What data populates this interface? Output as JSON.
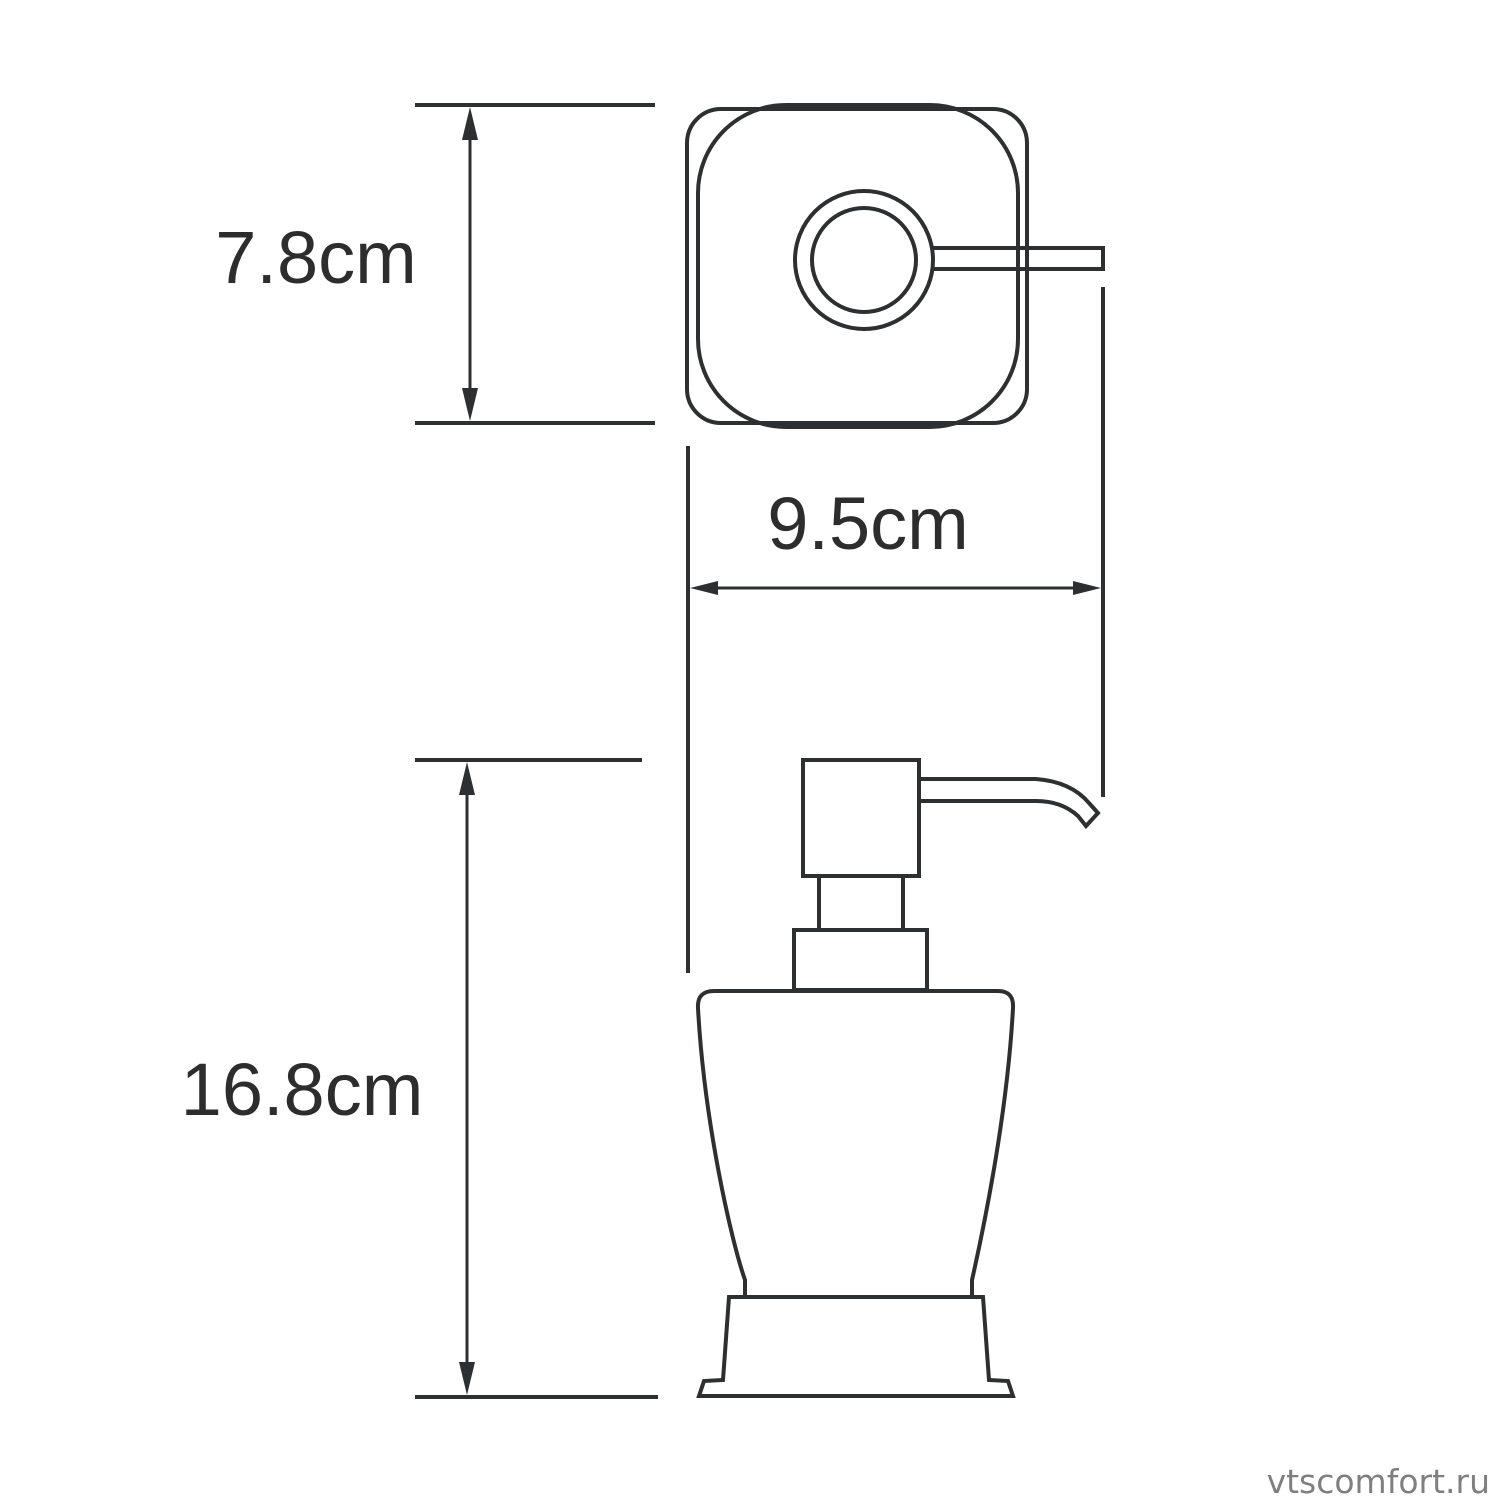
{
  "diagram": {
    "dimensions": [
      {
        "id": "top-view-depth",
        "label": "7.8cm"
      },
      {
        "id": "overall-width",
        "label": "9.5cm"
      },
      {
        "id": "body-height",
        "label": "16.8cm"
      }
    ],
    "watermark": "vtscomfort.ru",
    "colors": {
      "line": "#2d2f31",
      "text": "#2d2d2d",
      "watermark": "#7f7f7f",
      "background": "#ffffff"
    }
  }
}
